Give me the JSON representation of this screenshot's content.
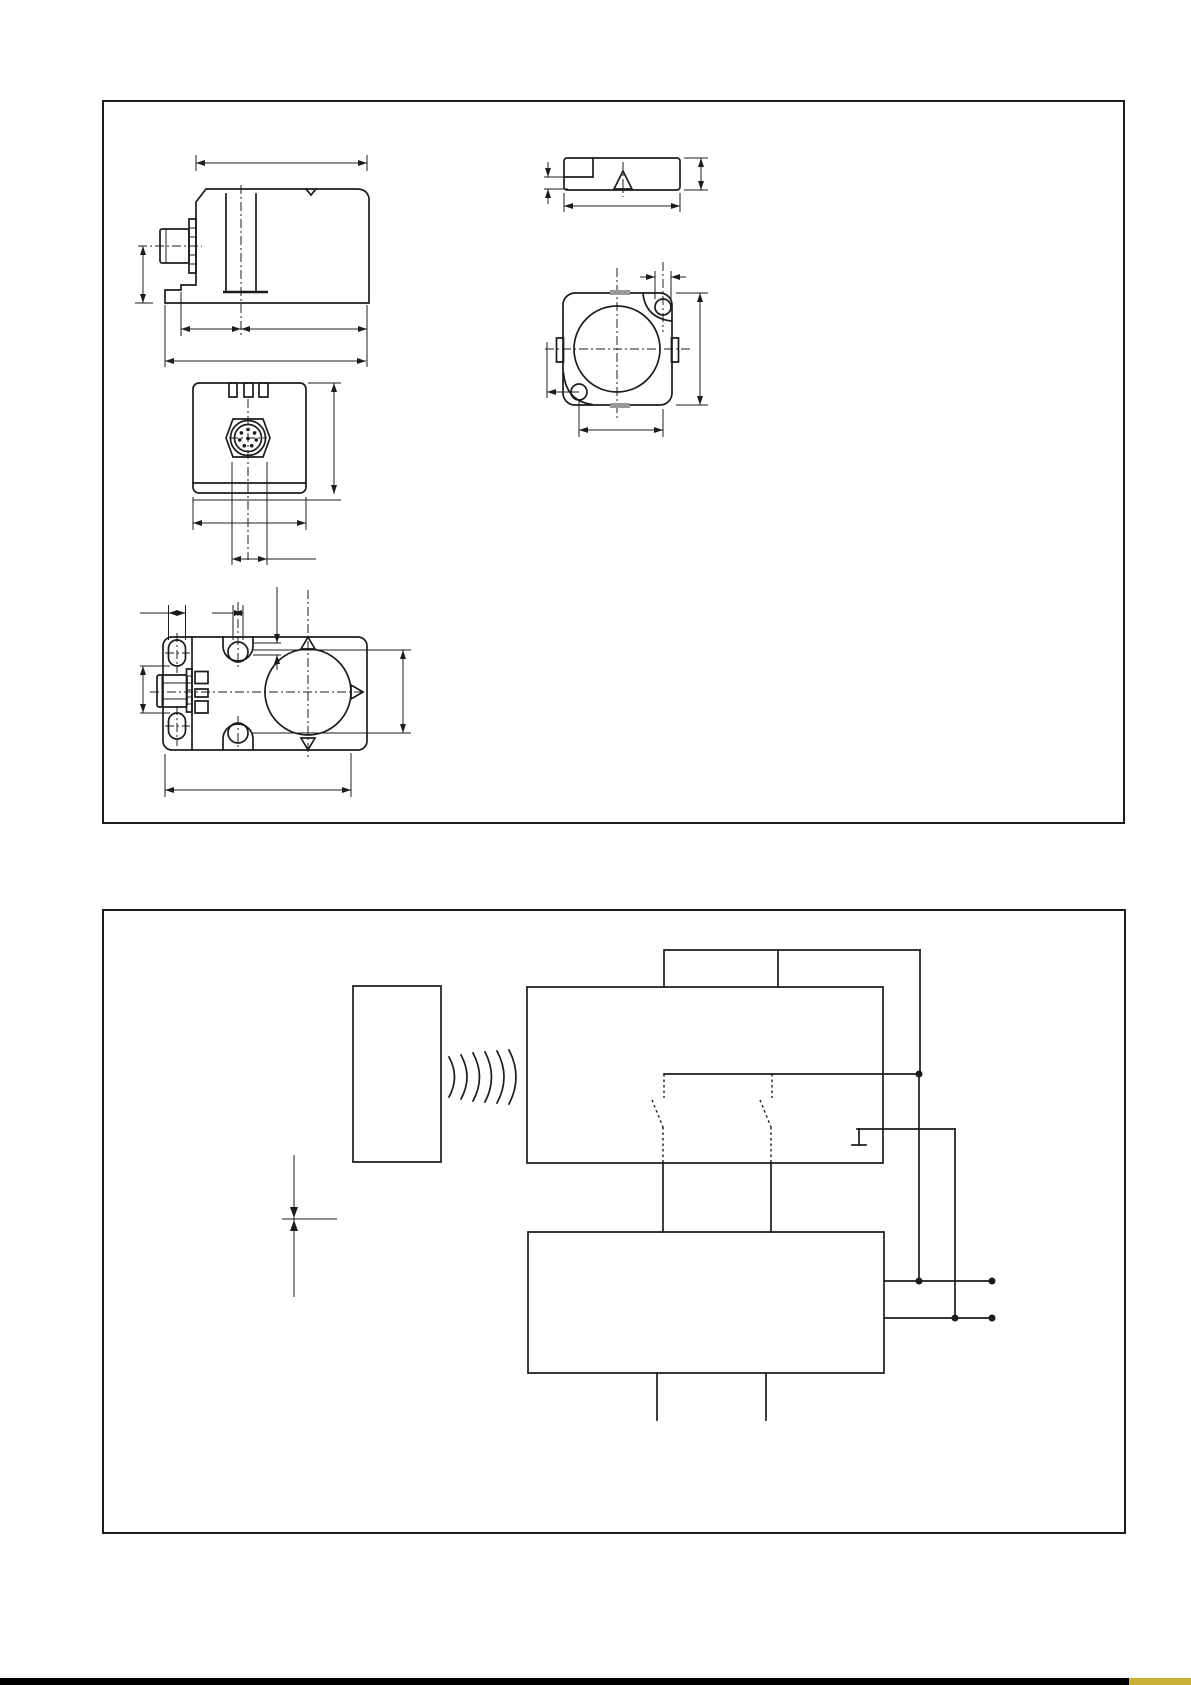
{
  "page": {
    "width": 1191,
    "height": 1685,
    "background": "#ffffff",
    "ink_color": "#1c1c1c"
  },
  "footer": {
    "bar_color": "#000000",
    "accent_color": "#c9b037"
  },
  "panels": [
    {
      "id": "dimension-drawings",
      "type": "technical-drawing",
      "views": 5
    },
    {
      "id": "function-block-diagram",
      "type": "schematic"
    }
  ],
  "icons": {
    "wireless_waves": "arc-set",
    "junction_dot": "filled-circle",
    "terminal_dot": "filled-circle",
    "ground_symbol": "tick-with-foot",
    "connector_pins": "8-pin-round-connector"
  }
}
